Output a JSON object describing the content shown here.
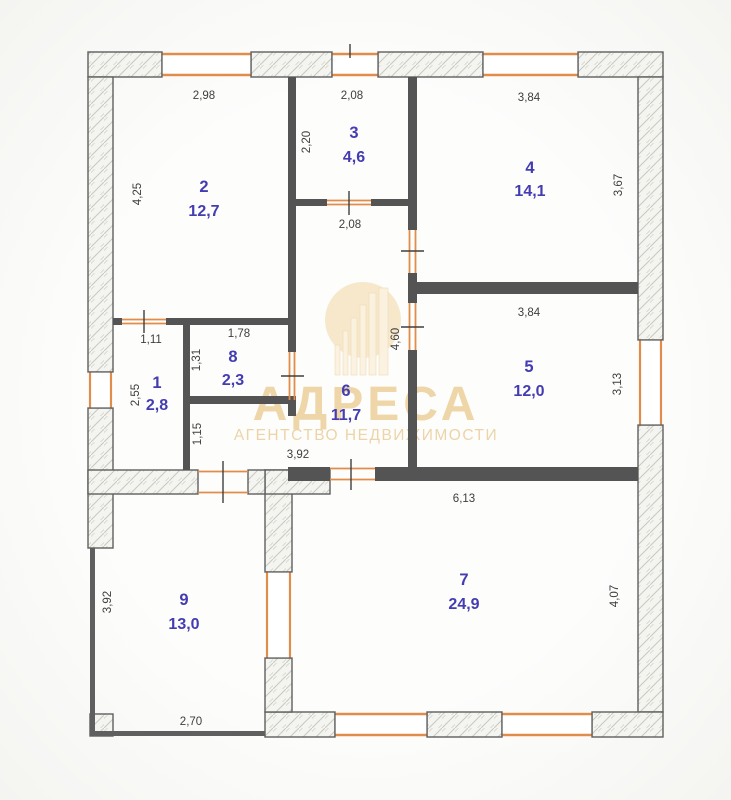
{
  "plan": {
    "rooms": [
      {
        "number": "1",
        "area": "2,8"
      },
      {
        "number": "2",
        "area": "12,7"
      },
      {
        "number": "3",
        "area": "4,6"
      },
      {
        "number": "4",
        "area": "14,1"
      },
      {
        "number": "5",
        "area": "12,0"
      },
      {
        "number": "6",
        "area": "11,7"
      },
      {
        "number": "7",
        "area": "24,9"
      },
      {
        "number": "8",
        "area": "2,3"
      },
      {
        "number": "9",
        "area": "13,0"
      }
    ],
    "dims": [
      "2,98",
      "4,25",
      "2,08",
      "2,20",
      "2,08",
      "3,84",
      "3,67",
      "3,84",
      "3,13",
      "1,11",
      "2,55",
      "1,78",
      "1,31",
      "1,15",
      "3,92",
      "4,60",
      "6,13",
      "4,07",
      "3,92",
      "2,70"
    ],
    "watermark": {
      "title": "АДРЕСА",
      "subtitle": "АГЕНТСТВО НЕДВИЖИМОСТИ"
    },
    "colors": {
      "opening_orange": "#e08c4a",
      "wall_gray": "#545454",
      "room_label_blue": "#433cb2",
      "watermark_gold": "#edd2a0"
    }
  }
}
